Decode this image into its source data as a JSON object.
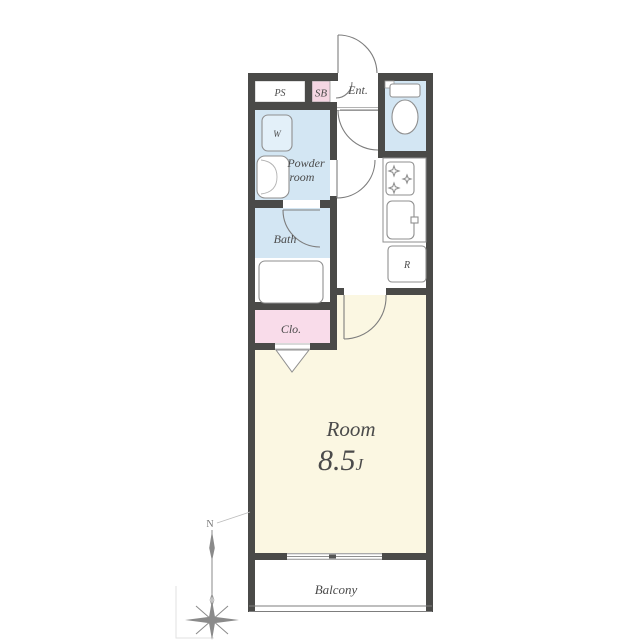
{
  "plan_type": "apartment-floor-plan",
  "labels": {
    "ps": "PS",
    "sb": "SB",
    "entrance": "Ent.",
    "washer": "W",
    "powder_line1": "Powder",
    "powder_line2": "room",
    "bath": "Bath",
    "closet": "Clo.",
    "fridge": "R",
    "room_name": "Room",
    "room_size": "8.5",
    "room_size_unit": "J",
    "balcony": "Balcony",
    "compass_north": "N"
  },
  "colors": {
    "wall": "#4a4a48",
    "water_blue": "#d3e6f3",
    "washer_blue": "#e3f0f9",
    "pink_sb": "#f5d6e3",
    "pink_closet": "#f9dcea",
    "room_cream": "#fbf7e2",
    "white": "#ffffff",
    "label_text": "#4b4b4b",
    "compass_gray": "#8a8a8a"
  },
  "icons": [
    "toilet-icon",
    "washer-icon",
    "washbasin-icon",
    "bathtub-icon",
    "stove-icon",
    "burner-icon",
    "sink-icon",
    "fridge-icon",
    "door-arc-icon",
    "folding-door-icon",
    "sliding-window-icon",
    "compass-rose-icon"
  ]
}
